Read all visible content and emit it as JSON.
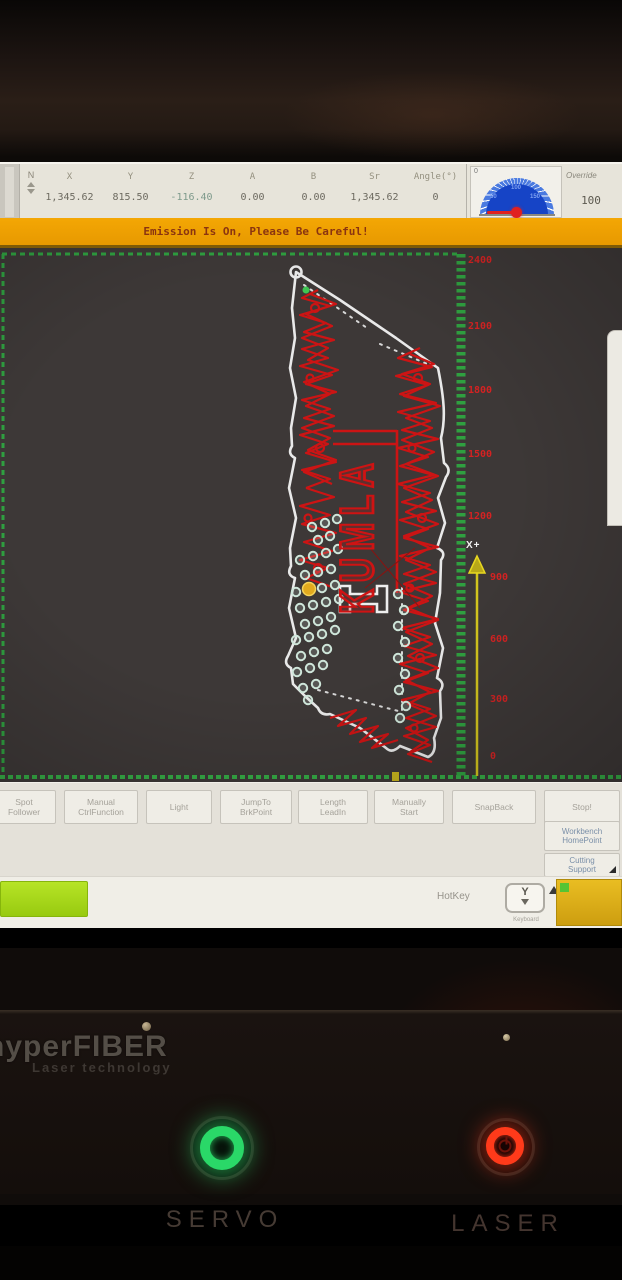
{
  "top_toolbar": {
    "spinner_label": "N",
    "axes": {
      "headers": [
        "X",
        "Y",
        "Z",
        "A",
        "B",
        "Sr",
        "Angle(°)"
      ],
      "values": [
        "1,345.62",
        "815.50",
        "-116.40",
        "0.00",
        "0.00",
        "1,345.62",
        "0"
      ]
    },
    "gauge": {
      "zero_label": "0",
      "tick_labels": [
        "50",
        "100",
        "150"
      ],
      "needle_color": "#e02020",
      "dial_color": "#1644c6"
    },
    "override": {
      "label": "Override",
      "value": "100"
    }
  },
  "warning_bar": {
    "text": "Emission Is On, Please Be Careful!",
    "bg_color": "#f2a202",
    "text_color": "#8a3410"
  },
  "canvas": {
    "ruler_labels": [
      "2400",
      "2100",
      "1800",
      "1500",
      "1200",
      "900",
      "600",
      "300",
      "0"
    ],
    "axis_arrow_label": "X+",
    "part_text": "KUMLA",
    "colors": {
      "background": "#3d3837",
      "border_green": "#2fa040",
      "toolpath_red": "#cc1414",
      "sheet_outline": "#e9e9e9",
      "pierce_dot": "#cfe6da",
      "highlight_dot": "#e2aa1e",
      "axis_yellow": "#d2c41e",
      "ruler_label_red": "#d42222"
    }
  },
  "action_bar": {
    "buttons": [
      {
        "line1": "Spot",
        "line2": "Follower"
      },
      {
        "line1": "Manual",
        "line2": "CtrlFunction"
      },
      {
        "line1": "Light",
        "line2": ""
      },
      {
        "line1": "JumpTo",
        "line2": "BrkPoint"
      },
      {
        "line1": "Length",
        "line2": "LeadIn"
      },
      {
        "line1": "Manually",
        "line2": "Start"
      },
      {
        "line1": "SnapBack",
        "line2": ""
      },
      {
        "line1": "Stop!",
        "line2": ""
      }
    ],
    "side_buttons": [
      {
        "line1": "Workbench",
        "line2": "HomePoint"
      },
      {
        "line1": "Cutting",
        "line2": "Support"
      }
    ]
  },
  "status_bar": {
    "hotkey_label": "HotKey",
    "key_label": "Y",
    "key_hint": "Keyboard"
  },
  "machine_panel": {
    "brand": "hyperFIBER",
    "brand_subtitle": "Laser technology",
    "servo_label": "SERVO",
    "laser_label": "LASER",
    "servo_on_color": "#2ad868",
    "laser_on_color": "#ff3a1a"
  }
}
